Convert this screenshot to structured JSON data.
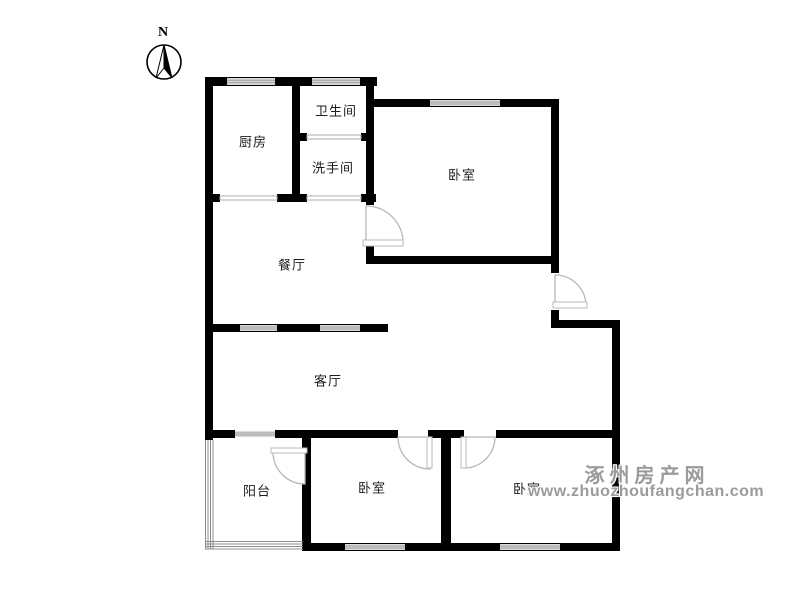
{
  "compass": {
    "label": "N"
  },
  "rooms": {
    "kitchen": {
      "label": "厨房"
    },
    "bathroom": {
      "label": "卫生间"
    },
    "washroom": {
      "label": "洗手间"
    },
    "bedroom_top": {
      "label": "卧室"
    },
    "dining": {
      "label": "餐厅"
    },
    "living": {
      "label": "客厅"
    },
    "balcony": {
      "label": "阳台"
    },
    "bedroom_middle": {
      "label": "卧室"
    },
    "bedroom_right": {
      "label": "卧室"
    }
  },
  "watermark": {
    "site_name": "涿州房产网",
    "url": "www.zhuozhoufangchan.com"
  },
  "colors": {
    "wall": "#000000",
    "window_fill": "#d9d9d9",
    "door_stroke": "#b8b8b8",
    "watermark_text": "#9b9b9b",
    "background": "#ffffff"
  }
}
